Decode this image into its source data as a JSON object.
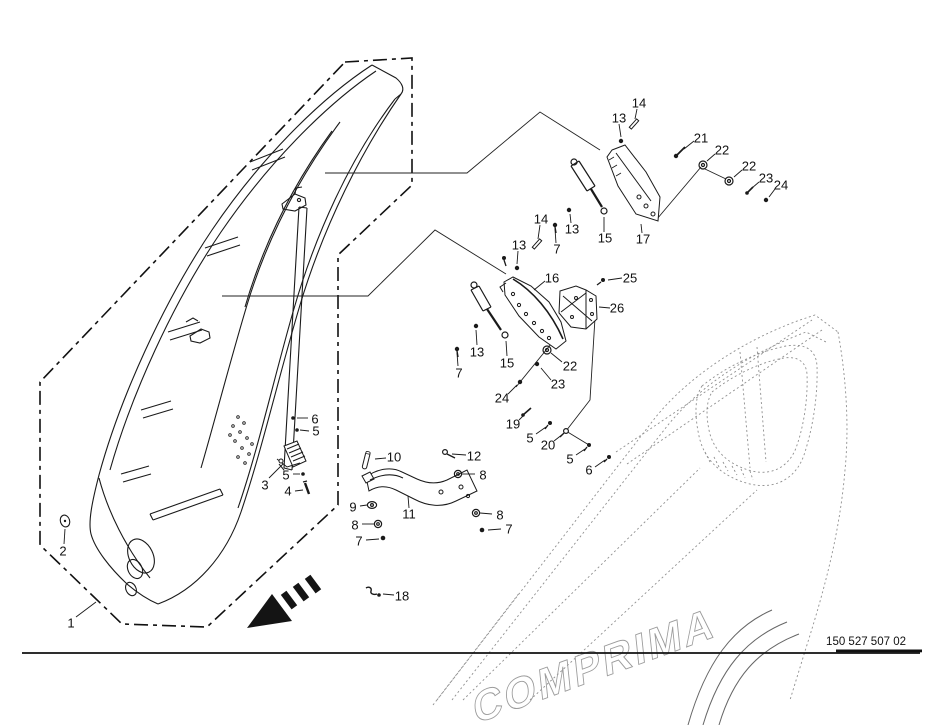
{
  "colors": {
    "background": "#ffffff",
    "line": "#1a1a1a",
    "hood_line": "#8f8f8f"
  },
  "footer": {
    "part_code": "150 527 507 02"
  },
  "hood": {
    "brand_text": "COMPRIMA"
  },
  "callouts": [
    {
      "n": "1",
      "x": 71,
      "y": 623,
      "leader": [
        76,
        617,
        96,
        602
      ]
    },
    {
      "n": "2",
      "x": 63,
      "y": 551,
      "leader": [
        64,
        544,
        65,
        529
      ]
    },
    {
      "n": "3",
      "x": 265,
      "y": 485,
      "leader": [
        269,
        478,
        283,
        464
      ]
    },
    {
      "n": "4",
      "x": 288,
      "y": 491,
      "leader": [
        295,
        491,
        303,
        490
      ]
    },
    {
      "n": "5",
      "x": 286,
      "y": 475,
      "leader": [
        293,
        474,
        300,
        474
      ]
    },
    {
      "n": "5",
      "x": 316,
      "y": 431,
      "leader": [
        309,
        431,
        300,
        430
      ]
    },
    {
      "n": "6",
      "x": 315,
      "y": 419,
      "leader": [
        308,
        418,
        297,
        418
      ]
    },
    {
      "n": "7",
      "x": 359,
      "y": 541,
      "leader": [
        366,
        540,
        379,
        539
      ]
    },
    {
      "n": "8",
      "x": 355,
      "y": 525,
      "leader": [
        362,
        524,
        374,
        524
      ]
    },
    {
      "n": "9",
      "x": 353,
      "y": 507,
      "leader": [
        360,
        506,
        367,
        505
      ]
    },
    {
      "n": "10",
      "x": 394,
      "y": 457,
      "leader": [
        386,
        458,
        375,
        459
      ]
    },
    {
      "n": "11",
      "x": 409,
      "y": 514,
      "leader": [
        409,
        508,
        408,
        496
      ]
    },
    {
      "n": "12",
      "x": 474,
      "y": 456,
      "leader": [
        466,
        455,
        452,
        454
      ]
    },
    {
      "n": "8",
      "x": 483,
      "y": 475,
      "leader": [
        475,
        474,
        462,
        474
      ]
    },
    {
      "n": "8",
      "x": 500,
      "y": 515,
      "leader": [
        492,
        514,
        480,
        513
      ]
    },
    {
      "n": "7",
      "x": 509,
      "y": 529,
      "leader": [
        501,
        529,
        488,
        530
      ]
    },
    {
      "n": "18",
      "x": 402,
      "y": 596,
      "leader": [
        394,
        595,
        383,
        594
      ]
    },
    {
      "n": "13",
      "x": 477,
      "y": 352,
      "leader": [
        477,
        345,
        476,
        330
      ]
    },
    {
      "n": "7",
      "x": 459,
      "y": 373,
      "leader": [
        458,
        366,
        457,
        353
      ]
    },
    {
      "n": "15",
      "x": 507,
      "y": 363,
      "leader": [
        507,
        356,
        506,
        341
      ]
    },
    {
      "n": "22",
      "x": 570,
      "y": 366,
      "leader": [
        562,
        362,
        551,
        353
      ]
    },
    {
      "n": "23",
      "x": 558,
      "y": 384,
      "leader": [
        551,
        380,
        541,
        368
      ]
    },
    {
      "n": "24",
      "x": 502,
      "y": 398,
      "leader": [
        508,
        394,
        517,
        385
      ]
    },
    {
      "n": "19",
      "x": 513,
      "y": 424,
      "leader": [
        519,
        420,
        524,
        415
      ]
    },
    {
      "n": "5",
      "x": 530,
      "y": 438,
      "leader": [
        536,
        434,
        546,
        427
      ]
    },
    {
      "n": "20",
      "x": 548,
      "y": 445,
      "leader": [
        554,
        441,
        563,
        434
      ]
    },
    {
      "n": "5",
      "x": 570,
      "y": 459,
      "leader": [
        576,
        455,
        585,
        449
      ]
    },
    {
      "n": "6",
      "x": 589,
      "y": 470,
      "leader": [
        595,
        467,
        605,
        460
      ]
    },
    {
      "n": "13",
      "x": 519,
      "y": 245,
      "leader": [
        518,
        251,
        517,
        264
      ]
    },
    {
      "n": "14",
      "x": 541,
      "y": 219,
      "leader": [
        540,
        225,
        538,
        239
      ]
    },
    {
      "n": "13",
      "x": 572,
      "y": 229,
      "leader": [
        571,
        223,
        570,
        214
      ]
    },
    {
      "n": "7",
      "x": 557,
      "y": 249,
      "leader": [
        556,
        243,
        555,
        229
      ]
    },
    {
      "n": "15",
      "x": 605,
      "y": 238,
      "leader": [
        604,
        232,
        604,
        217
      ]
    },
    {
      "n": "17",
      "x": 643,
      "y": 239,
      "leader": [
        642,
        233,
        641,
        224
      ]
    },
    {
      "n": "16",
      "x": 552,
      "y": 278,
      "leader": [
        545,
        281,
        534,
        290
      ]
    },
    {
      "n": "25",
      "x": 630,
      "y": 278,
      "leader": [
        622,
        278,
        608,
        280
      ]
    },
    {
      "n": "26",
      "x": 617,
      "y": 308,
      "leader": [
        610,
        308,
        599,
        307
      ]
    },
    {
      "n": "13",
      "x": 619,
      "y": 118,
      "leader": [
        619,
        124,
        621,
        137
      ]
    },
    {
      "n": "14",
      "x": 639,
      "y": 103,
      "leader": [
        637,
        109,
        635,
        119
      ]
    },
    {
      "n": "21",
      "x": 701,
      "y": 138,
      "leader": [
        694,
        141,
        684,
        149
      ]
    },
    {
      "n": "22",
      "x": 722,
      "y": 150,
      "leader": [
        715,
        154,
        707,
        161
      ]
    },
    {
      "n": "22",
      "x": 749,
      "y": 166,
      "leader": [
        742,
        170,
        734,
        177
      ]
    },
    {
      "n": "23",
      "x": 766,
      "y": 178,
      "leader": [
        759,
        182,
        752,
        188
      ]
    },
    {
      "n": "24",
      "x": 781,
      "y": 185,
      "leader": [
        775,
        189,
        769,
        197
      ]
    }
  ]
}
